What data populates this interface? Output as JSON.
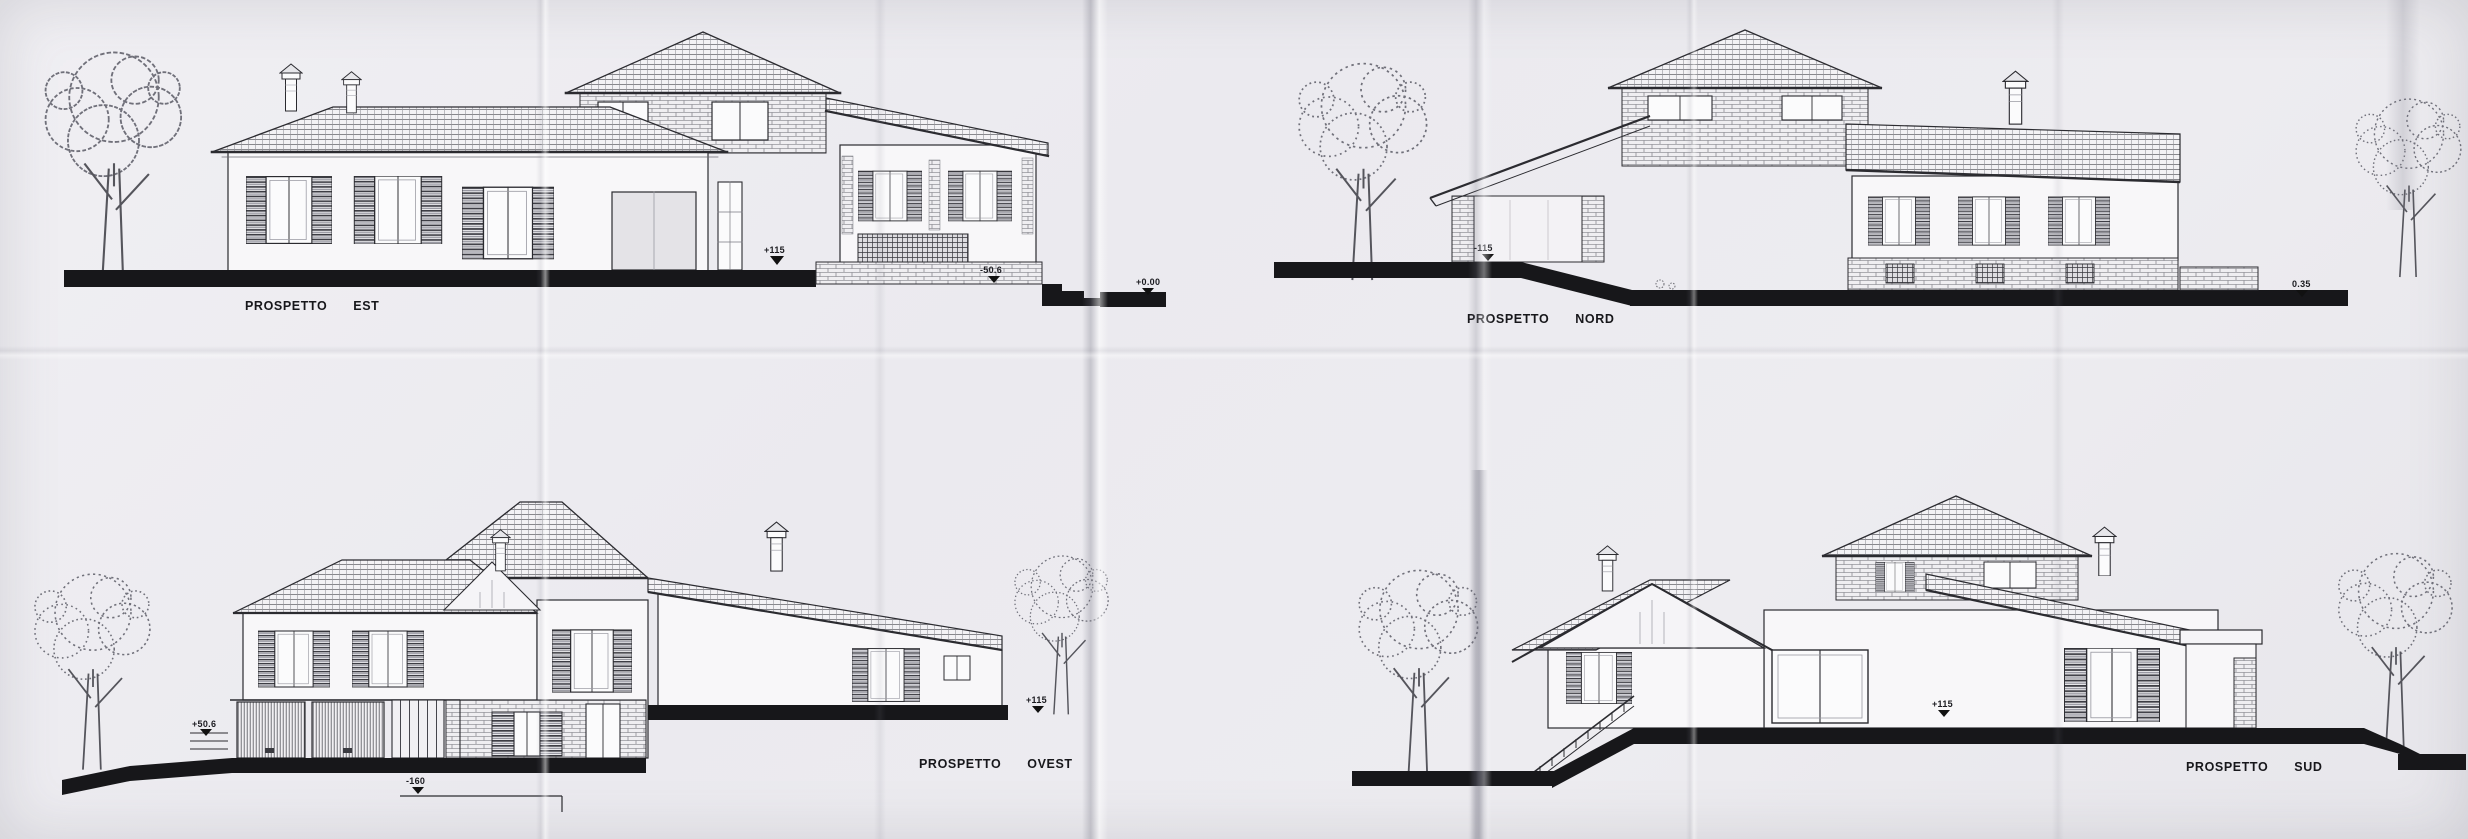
{
  "sheet": {
    "kind": "scanned architectural elevations sheet",
    "colors": {
      "paper": "#edecf0",
      "ink": "#2b2b30",
      "ground": "#17171a"
    }
  },
  "elevations": [
    {
      "name": "est",
      "label": {
        "word1": "PROSPETTO",
        "word2": "EST"
      },
      "markers": [
        "+115",
        "-50.6",
        "+0.00"
      ]
    },
    {
      "name": "nord",
      "label": {
        "word1": "PROSPETTO",
        "word2": "NORD"
      },
      "markers": [
        "-115",
        "0.35"
      ]
    },
    {
      "name": "ovest",
      "label": {
        "word1": "PROSPETTO",
        "word2": "OVEST"
      },
      "markers": [
        "+50.6",
        "+115",
        "-160"
      ]
    },
    {
      "name": "sud",
      "label": {
        "word1": "PROSPETTO",
        "word2": "SUD"
      },
      "markers": [
        "+115"
      ]
    }
  ]
}
